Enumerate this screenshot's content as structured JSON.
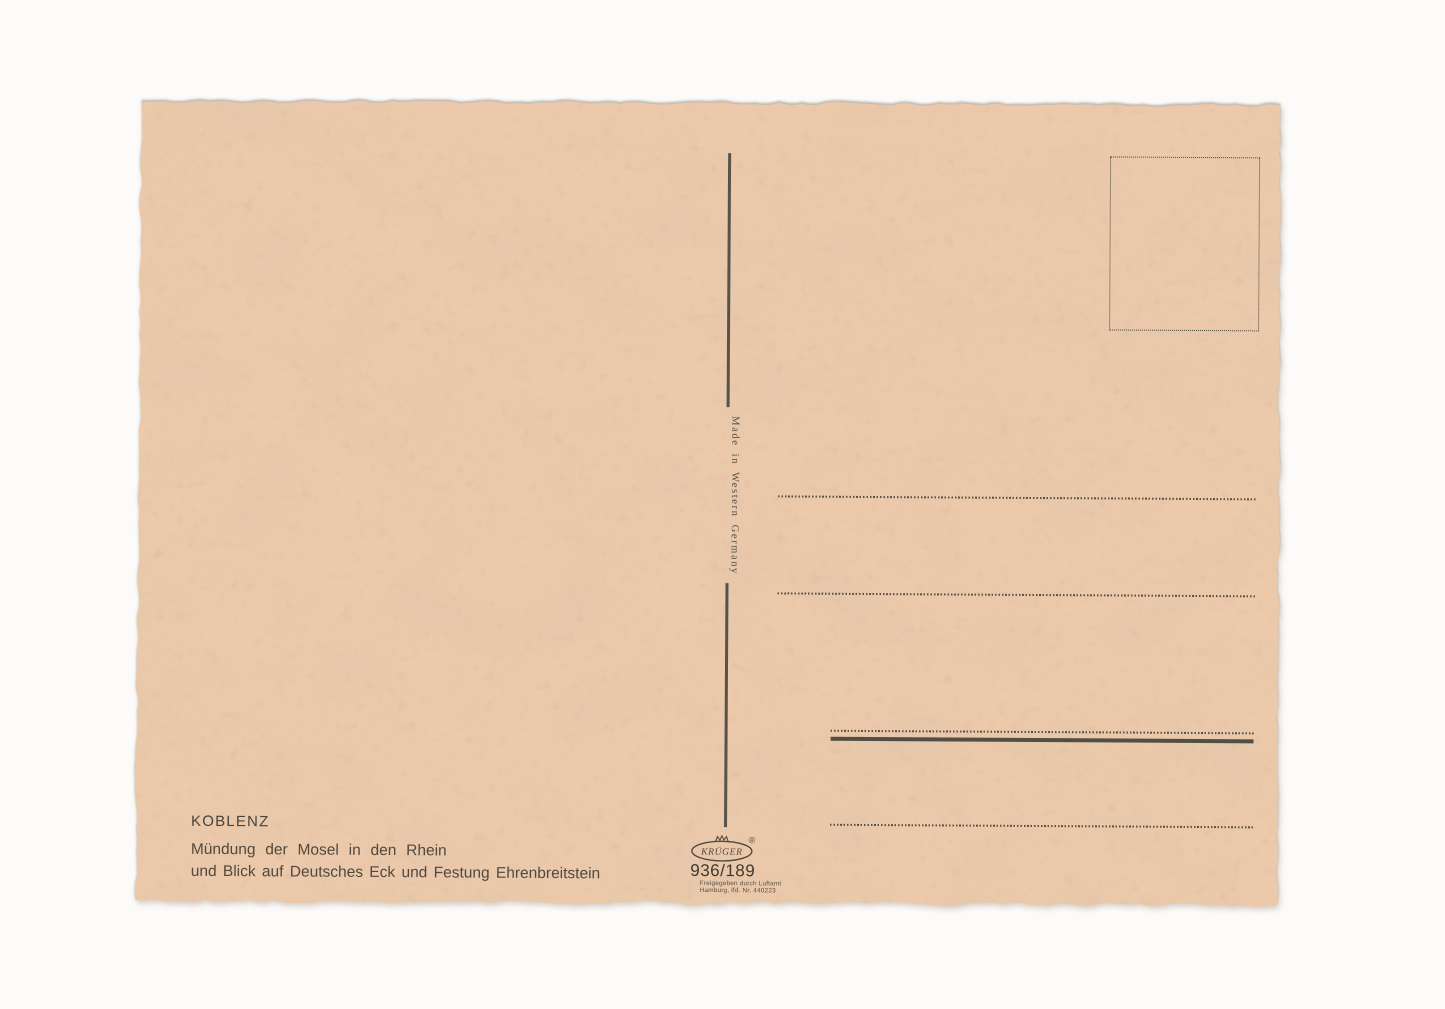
{
  "postcard": {
    "paper_color": "#ecc9ab",
    "ink_color": "#4e4b41",
    "caption": {
      "title": "KOBLENZ",
      "subtitle_line1": "Mündung der Mosel in den Rhein",
      "subtitle_line2": "und Blick auf Deutsches Eck und Festung Ehrenbreitstein"
    },
    "divider": {
      "made_in_label": "Made in Western Germany"
    },
    "publisher": {
      "brand": "KRÜGER",
      "registered_mark": "®",
      "card_number": "936/189",
      "license_line1": "Freigegeben durch Luftamt",
      "license_line2": "Hamburg, lfd. Nr. 440223"
    }
  }
}
